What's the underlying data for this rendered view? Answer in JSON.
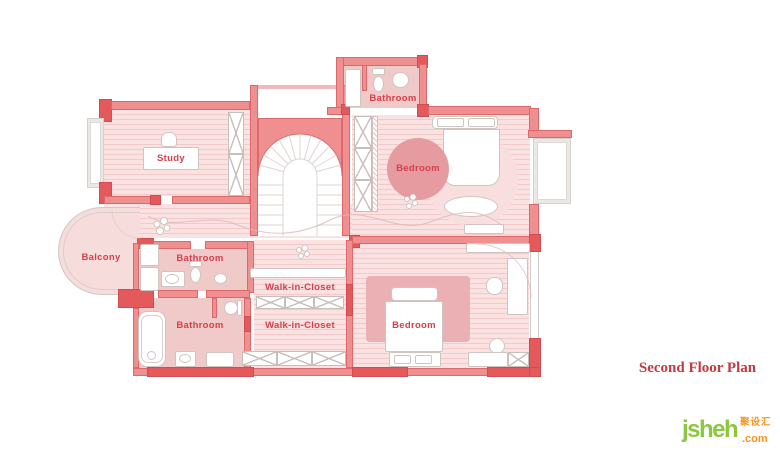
{
  "title": "Second Floor Plan",
  "watermark": {
    "brand": "jsheh",
    "tld": ".com",
    "cn_name": "聚设汇"
  },
  "rooms": {
    "study": "Study",
    "bathroom_top": "Bathroom",
    "bedroom_top": "Bedroom",
    "balcony": "Balcony",
    "bathroom_mid": "Bathroom",
    "bathroom_low": "Bathroom",
    "closet_upper": "Walk-in-Closet",
    "closet_lower": "Walk-in-Closet",
    "bedroom_low": "Bedroom"
  },
  "colors": {
    "wall": "#ef8f90",
    "wall_dark": "#e4595c",
    "floor_light": "#fae2e2",
    "floor_stripe": "#f3c9c9",
    "room_fill": "#f0c9c9",
    "rug_dark": "#eab0b4",
    "circle_rug": "#e59ba0",
    "balcony_gray": "#eae7e5",
    "label_red": "#d6404a",
    "title_red": "#c23b3e",
    "logo_green": "#8dc63f",
    "logo_orange": "#f7941d"
  }
}
